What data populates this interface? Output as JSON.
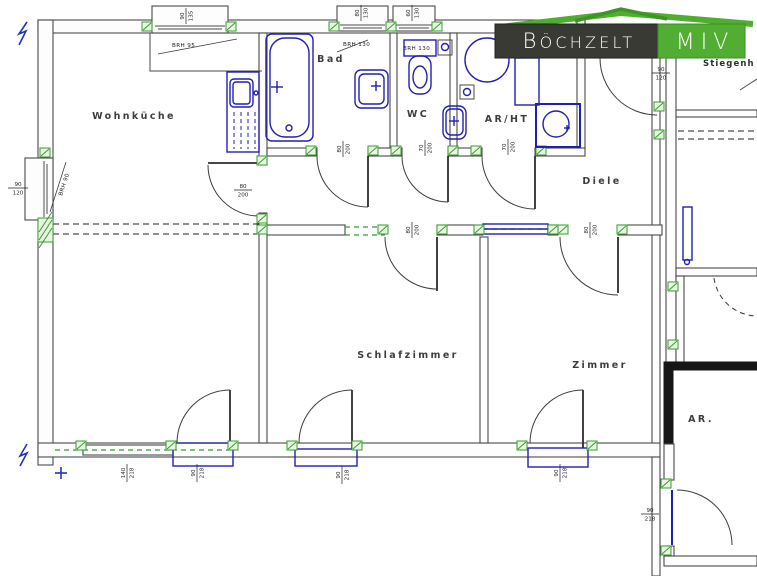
{
  "logo": {
    "company": "BÖCHZELT",
    "unit": "MIV"
  },
  "rooms": {
    "wohnkueche": "Wohnküche",
    "bad": "Bad",
    "wc": "WC",
    "ar_ht": "AR/HT",
    "diele": "Diele",
    "schlafzimmer": "Schlafzimmer",
    "zimmer": "Zimmer",
    "abstellraum": "AR.",
    "stiegenhaus": "Stiegenh"
  },
  "annotations": {
    "brh_top_window": "BRH 95",
    "brh_bad_window": "BRH 130",
    "brh_wc_window": "BRH 130",
    "brh_left_window": "BRH 90"
  },
  "dims": {
    "win_top": {
      "w": "90",
      "h": "135"
    },
    "win_bad": {
      "w": "80",
      "h": "130"
    },
    "win_wc": {
      "w": "60",
      "h": "130"
    },
    "win_left": {
      "w": "90",
      "h": "120"
    },
    "door_kitchen": {
      "w": "80",
      "h": "200"
    },
    "door_bad": {
      "w": "80",
      "h": "200"
    },
    "door_wc": {
      "w": "70",
      "h": "200"
    },
    "door_arht": {
      "w": "70",
      "h": "200"
    },
    "door_schlaf": {
      "w": "80",
      "h": "200"
    },
    "door_zimmer": {
      "w": "80",
      "h": "200"
    },
    "dim_stiegenhaus": {
      "w": "90",
      "h": "120"
    },
    "win_bottom": {
      "w": "140",
      "h": "218"
    },
    "door_balc_wohn": {
      "w": "90",
      "h": "218"
    },
    "door_balc_schlaf": {
      "w": "90",
      "h": "218"
    },
    "door_balc_zimmer": {
      "w": "90",
      "h": "218"
    },
    "door_ar": {
      "w": "90",
      "h": "218"
    }
  },
  "colors": {
    "fixture_blue": "#2020b0",
    "marker_green": "#379c2d",
    "logo_green": "#52ae32",
    "logo_dark": "#3a3a35",
    "wall_gray": "#4a4a4a"
  }
}
